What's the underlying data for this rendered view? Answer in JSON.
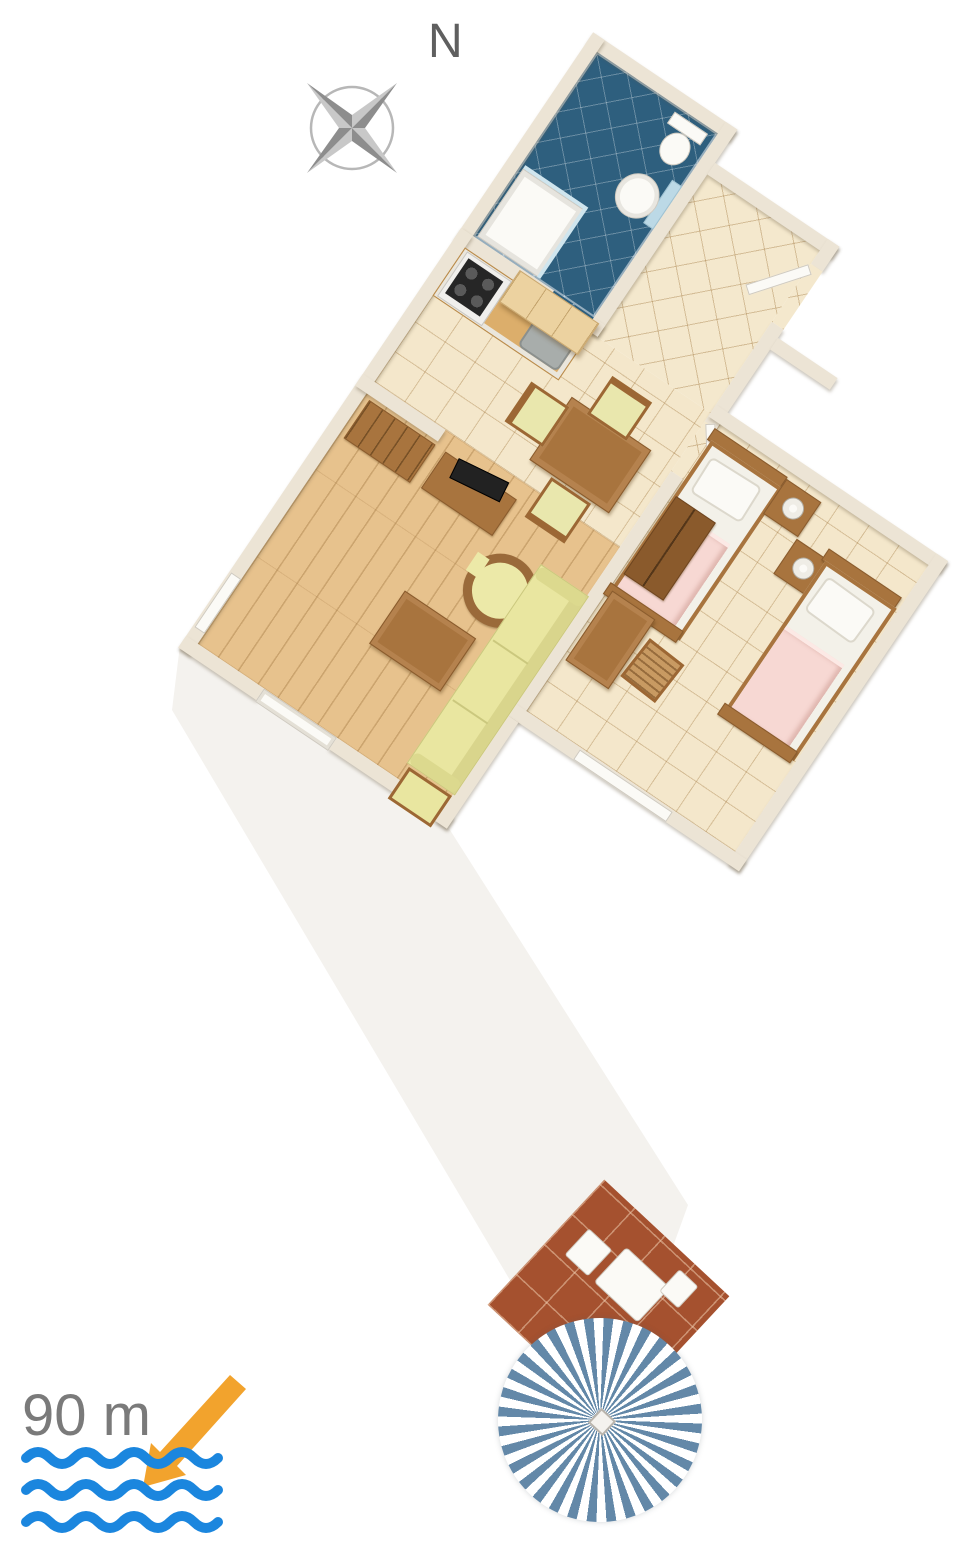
{
  "labels": {
    "north": "N",
    "distance_to_sea": "90 m"
  },
  "icons": {
    "compass": "compass-rose",
    "arrow": "sea-direction-arrow",
    "waves": "sea-waves",
    "parasol": "parasol-top-view"
  },
  "colors": {
    "arrow_orange": "#F2A32D",
    "waves_blue": "#1B86DE",
    "label_gray": "#7A7A7A",
    "compass_gray": "#9A9A9A",
    "wall_beige": "#ECE4D5",
    "tile_beige": "#F4E7CB",
    "bathroom_floor_blue": "#2E5F7E",
    "wood_floor": "#E7C28D",
    "terrace_terracotta": "#A5512F",
    "parasol_blue": "#6388A8",
    "bed_blanket_pink": "#F7D8D3",
    "sofa_yellow": "#E9E6A0",
    "furniture_brown": "#A8743E"
  }
}
